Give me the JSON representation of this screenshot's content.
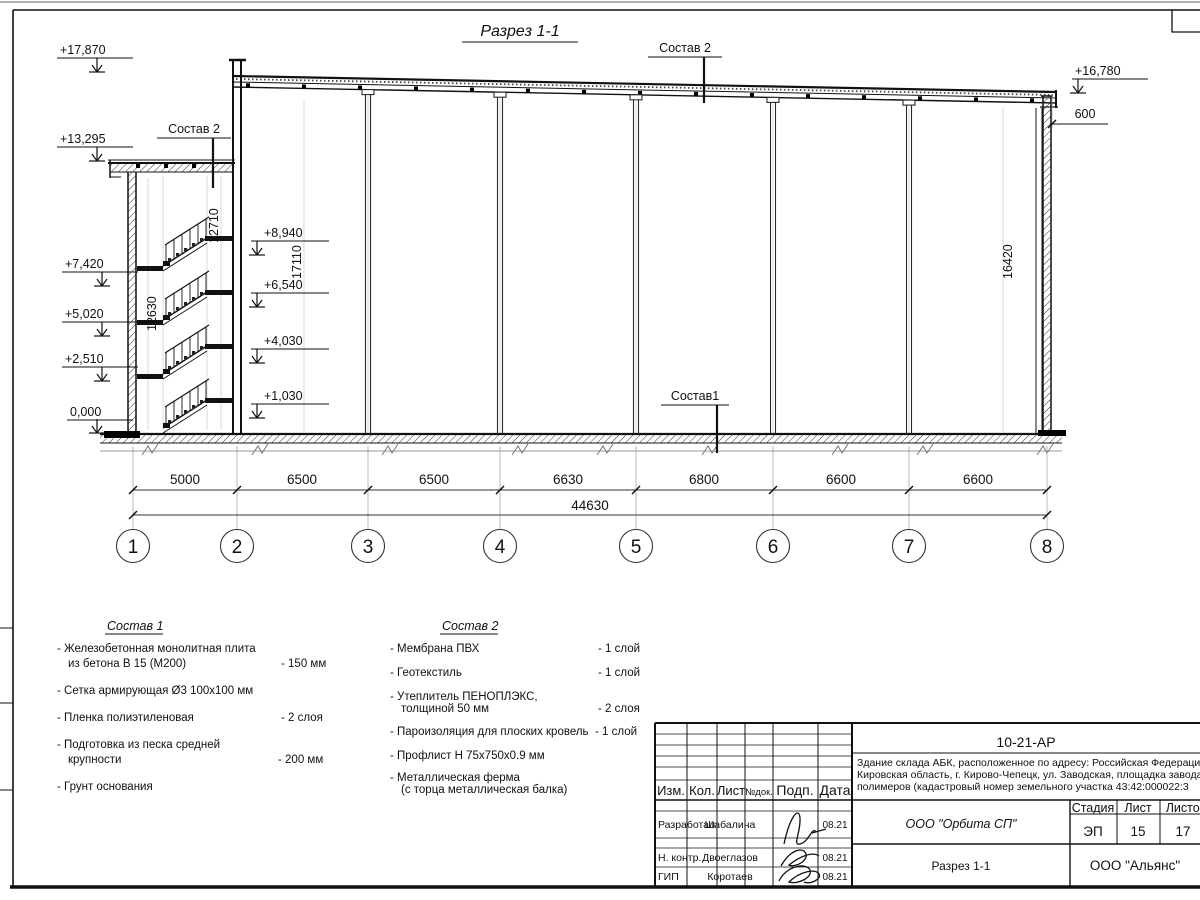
{
  "drawing": {
    "title": "Разрез 1-1",
    "callouts": {
      "roof_main": "Состав 2",
      "roof_tower": "Состав 2",
      "floor": "Состав1"
    },
    "elev_left": [
      "+17,870",
      "+13,295",
      "+7,420",
      "+5,020",
      "+2,510",
      "0,000"
    ],
    "elev_mid": [
      "+8,940",
      "+6,540",
      "+4,030",
      "+1,030"
    ],
    "elev_right": "+16,780",
    "dim_parapet": "600",
    "vdims": {
      "v12710": "12710",
      "v12630": "12630",
      "v17110": "17110",
      "v16420": "16420"
    },
    "bottom_dims": [
      "5000",
      "6500",
      "6500",
      "6630",
      "6800",
      "6600",
      "6600"
    ],
    "total_dim": "44630",
    "axes": [
      "1",
      "2",
      "3",
      "4",
      "5",
      "6",
      "7",
      "8"
    ]
  },
  "notes_sostav1": {
    "title": "Состав 1",
    "rows": [
      {
        "l1": "- Железобетонная  монолитная плита",
        "l2": "из бетона В 15 (М200)",
        "val": "- 150 мм"
      },
      {
        "l1": "- Сетка армирующая Ø3 100х100 мм",
        "l2": "",
        "val": ""
      },
      {
        "l1": "- Пленка полиэтиленовая",
        "l2": "",
        "val": "-  2 слоя"
      },
      {
        "l1": "- Подготовка из песка средней",
        "l2": "крупности",
        "val": "- 200 мм"
      },
      {
        "l1": "- Грунт основания",
        "l2": "",
        "val": ""
      }
    ]
  },
  "notes_sostav2": {
    "title": "Состав 2",
    "rows": [
      {
        "l1": "- Мембрана ПВХ",
        "l2": "",
        "val": "- 1 слой"
      },
      {
        "l1": "- Геотекстиль",
        "l2": "",
        "val": "- 1 слой"
      },
      {
        "l1": "- Утеплитель ПЕНОПЛЭКС,",
        "l2": "толщиной 50 мм",
        "val": "- 2 слоя"
      },
      {
        "l1": "- Пароизоляция для плоских кровель",
        "l2": "",
        "val": "- 1 слой"
      },
      {
        "l1": "- Профлист Н 75х750х0.9 мм",
        "l2": "",
        "val": ""
      },
      {
        "l1": "- Металлическая ферма",
        "l2": "(с торца металлическая балка)",
        "val": ""
      }
    ]
  },
  "titleblock": {
    "doc_number": "10-21-АР",
    "object_line1": "Здание склада АБК, расположенное по адресу: Российская Федерация,",
    "object_line2": "Кировская область, г. Кирово-Чепецк, ул. Заводская, площадка завода",
    "object_line3": "полимеров (кадастровый номер земельного участка 43:42:000022:3",
    "cols": {
      "izm": "Изм.",
      "kol": "Кол.",
      "list": "Лист",
      "ndoc": "№док.",
      "podp": "Подп.",
      "data": "Дата"
    },
    "roles": [
      {
        "role": "Разработал",
        "name": "Шабалина",
        "date": "08.21"
      },
      {
        "role": "Н. контр.",
        "name": "Двоеглазов",
        "date": "08.21"
      },
      {
        "role": "ГИП",
        "name": "Коротаев",
        "date": "08.21"
      }
    ],
    "org": "ООО \"Орбита СП\"",
    "sheet_title": "Разрез 1-1",
    "contractor": "ООО \"Альянс\"",
    "stage_label": "Стадия",
    "sheet_label": "Лист",
    "sheets_label": "Листов",
    "stage": "ЭП",
    "sheet_no": "15",
    "sheets_total": "17"
  }
}
